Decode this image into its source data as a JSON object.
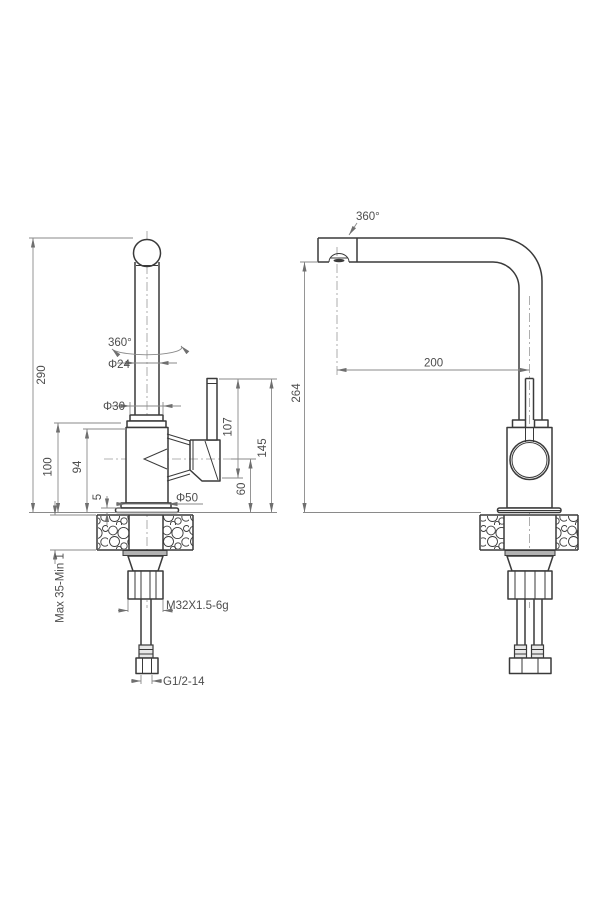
{
  "drawing": {
    "subject": "kitchen-faucet-installation-drawing",
    "background": "#ffffff",
    "line_color": "#3a3a3a",
    "dimension_color": "#8a8a8a"
  },
  "front_view": {
    "overall_height": "290",
    "swivel_angle": "360°",
    "spout_pipe_diameter": "Φ24",
    "base_ring_diameter": "Φ30",
    "body_top_height": "100",
    "body_height": "94",
    "base_plate_height": "5",
    "body_diameter": "Φ50",
    "handle_to_pivot": "107",
    "handle_top_height": "145",
    "pivot_height": "60",
    "counter_thickness": "Max 35-Min 1",
    "mounting_thread": "M32X1.5-6g",
    "inlet_thread": "G1/2-14"
  },
  "side_view": {
    "swivel_angle": "360°",
    "spout_reach": "200",
    "spout_height": "264"
  }
}
